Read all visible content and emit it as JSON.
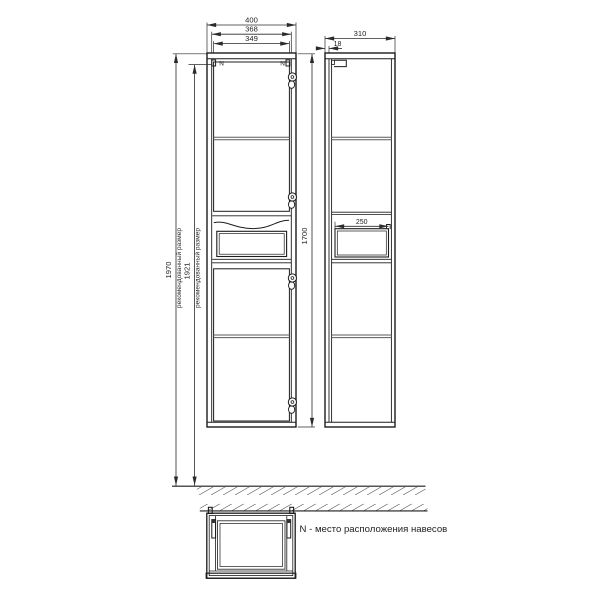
{
  "drawing": {
    "type": "technical-dimension-drawing",
    "subject": "tall cabinet (pencil case) front / side / top views",
    "front_view": {
      "width_total_mm": "400",
      "width_inner_mm": "368",
      "width_door_mm": "349",
      "height_recommended_mm": "1970",
      "height_recommended_label": "рекомендованный размер",
      "height_hanger_mm": "1921",
      "height_hanger_label": "рекомендованный размер",
      "height_body_mm": "1700",
      "hanger_mark_left": "N",
      "hanger_mark_right": "N"
    },
    "side_view": {
      "depth_total_mm": "310",
      "door_thickness_mm": "18",
      "niche_depth_mm": "250"
    },
    "note": "N - место расположения навесов",
    "colors": {
      "background": "#ffffff",
      "outline": "#1c1c1c",
      "dimension": "#2b2b2b",
      "shelf_line": "#5a5a5a"
    }
  }
}
